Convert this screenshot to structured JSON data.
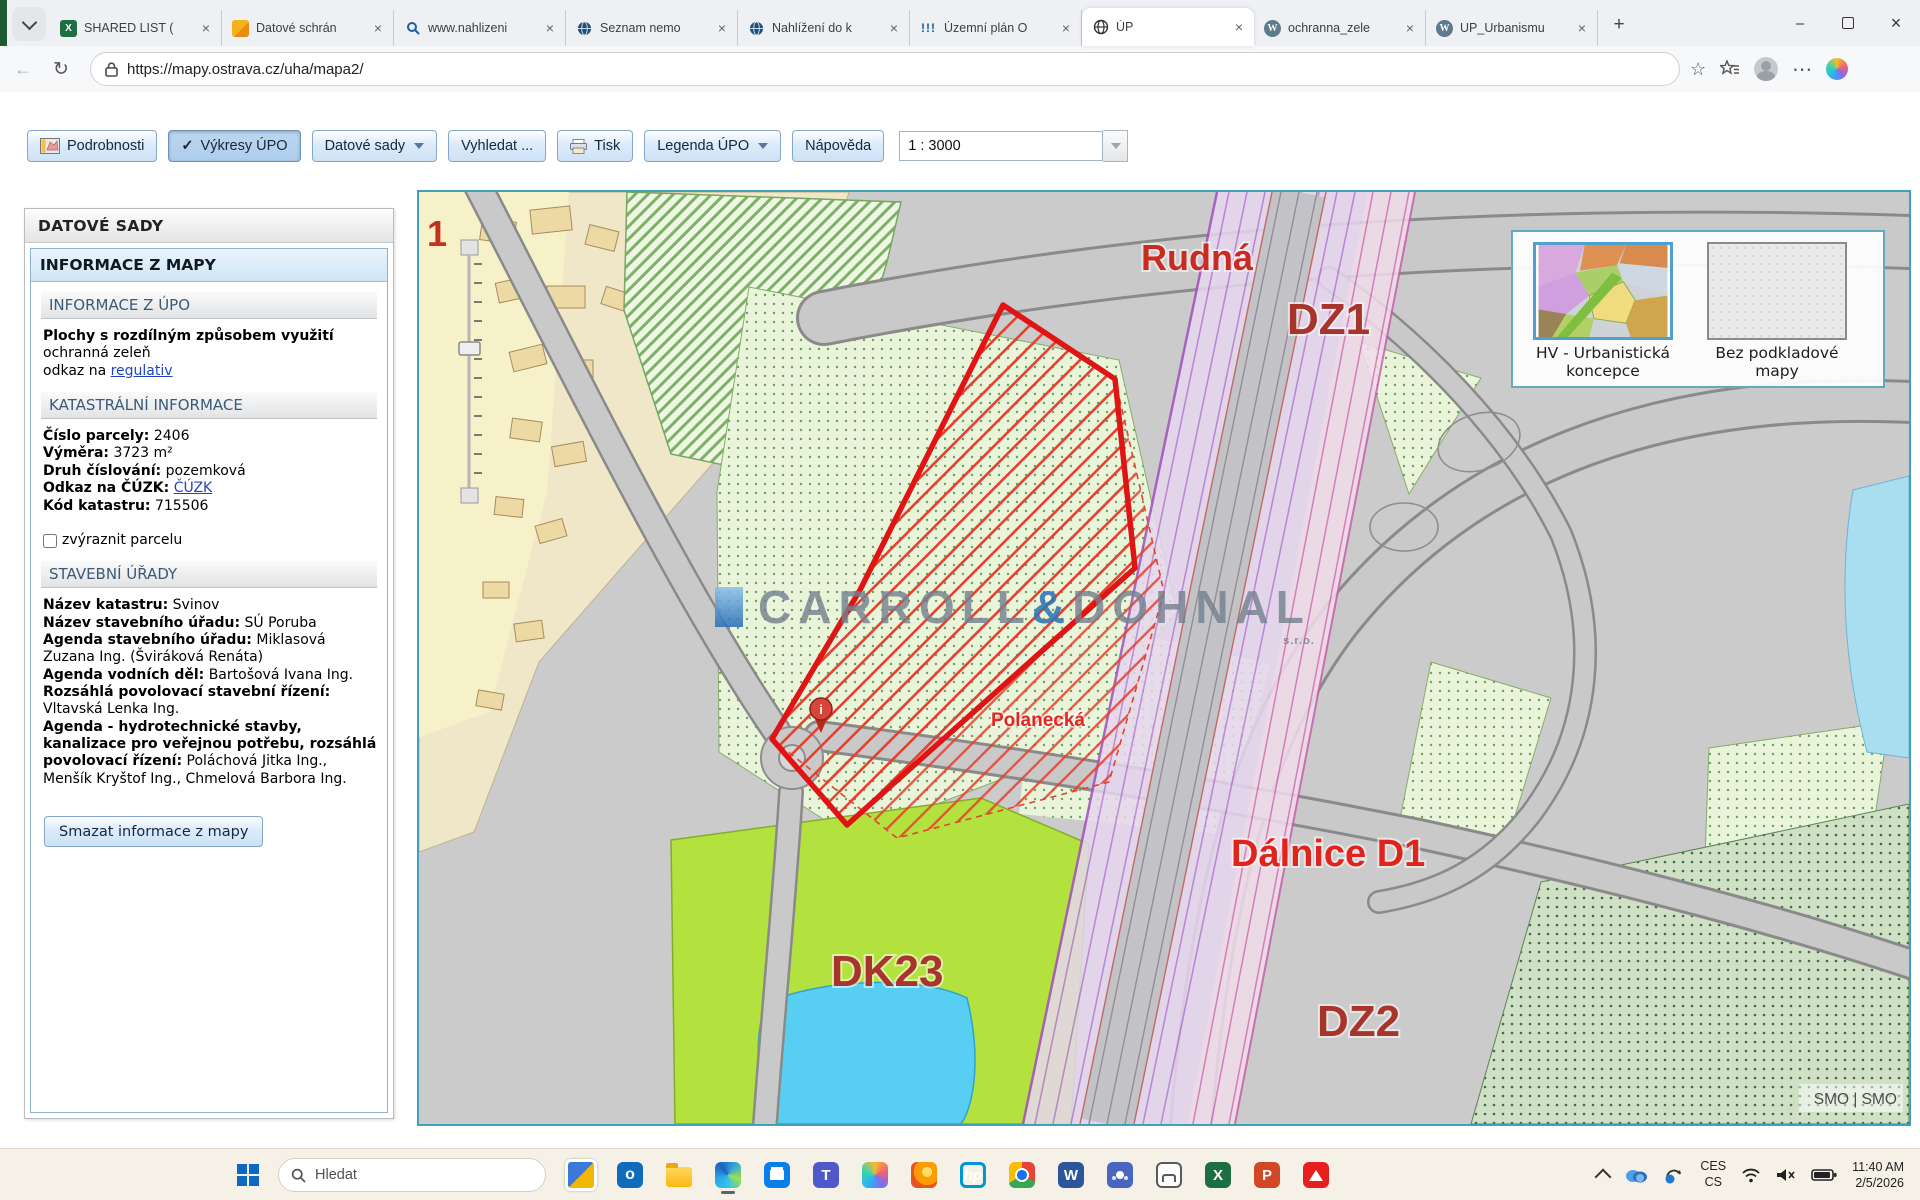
{
  "browser": {
    "tabs": [
      {
        "label": "SHARED LIST ("
      },
      {
        "label": "Datové schrán"
      },
      {
        "label": "www.nahlizeni"
      },
      {
        "label": "Seznam nemo"
      },
      {
        "label": "Nahlížení do k"
      },
      {
        "label": "Územní plán O"
      },
      {
        "label": "ÚP"
      },
      {
        "label": "ochranna_zele"
      },
      {
        "label": "UP_Urbanismu"
      }
    ],
    "url": "https://mapy.ostrava.cz/uha/mapa2/"
  },
  "toolbar": {
    "podrobnosti": "Podrobnosti",
    "vykresy": "Výkresy ÚPO",
    "datove_sady": "Datové sady",
    "vyhledat": "Vyhledat ...",
    "tisk": "Tisk",
    "legenda": "Legenda ÚPO",
    "napoveda": "Nápověda",
    "scale": "1 : 3000"
  },
  "sidebar": {
    "title": "DATOVÉ SADY",
    "panel_title": "INFORMACE Z MAPY",
    "upo": {
      "title": "INFORMACE Z ÚPO",
      "heading": "Plochy s rozdílným způsobem využití",
      "line1": "ochranná zeleň",
      "line2_prefix": "odkaz na ",
      "line2_link": "regulativ"
    },
    "katastr": {
      "title": "KATASTRÁLNÍ INFORMACE",
      "rows": [
        {
          "label": "Číslo parcely:",
          "value": "2406"
        },
        {
          "label": "Výměra:",
          "value": "3723 m²"
        },
        {
          "label": "Druh číslování:",
          "value": "pozemková"
        },
        {
          "label": "Odkaz na ČÚZK:",
          "value": "ČÚZK"
        },
        {
          "label": "Kód katastru:",
          "value": "715506"
        }
      ],
      "checkbox_label": "zvýraznit parcelu"
    },
    "urady": {
      "title": "STAVEBNÍ ÚŘADY",
      "rows": [
        {
          "label": "Název katastru:",
          "value": "Svinov"
        },
        {
          "label": "Název stavebního úřadu:",
          "value": "SÚ Poruba"
        },
        {
          "label": "Agenda stavebního úřadu:",
          "value": "Miklasová Zuzana Ing. (Šviráková Renáta)"
        },
        {
          "label": "Agenda vodních děl:",
          "value": "Bartošová Ivana Ing."
        },
        {
          "label": "Rozsáhlá povolovací stavební řízení:",
          "value": "Vltavská Lenka Ing."
        },
        {
          "label": "Agenda - hydrotechnické stavby, kanalizace pro veřejnou potřebu, rozsáhlá povolovací řízení:",
          "value": "Poláchová Jitka Ing., Menšík Kryštof Ing., Chmelová Barbora Ing."
        }
      ]
    },
    "clear_button": "Smazat informace z mapy"
  },
  "map": {
    "labels": {
      "marker1": "1",
      "rudna": "Rudná",
      "dz1": "DZ1",
      "polanecka": "Polanecká",
      "dalnice": "Dálnice D1",
      "dk23": "DK23",
      "dz2": "DZ2",
      "info_i": "i"
    },
    "watermark": {
      "part1": "CARROLL",
      "amp": "&",
      "part2": "DOHNAL",
      "suffix": "s.r.o."
    },
    "attribution": "SMO | SMO",
    "layers": [
      {
        "label": "HV - Urbanistická koncepce",
        "selected": true
      },
      {
        "label": "Bez podkladové mapy",
        "selected": false
      }
    ],
    "colors": {
      "parcel_red": "#e01414",
      "map_border": "#42a0bf",
      "label_dark_red": "#a8352c",
      "label_bright_red": "#e0241c"
    }
  },
  "taskbar": {
    "search": "Hledat",
    "lang1": "CES",
    "lang2": "CS",
    "time": "11:40 AM",
    "date": "2/5/2026"
  }
}
